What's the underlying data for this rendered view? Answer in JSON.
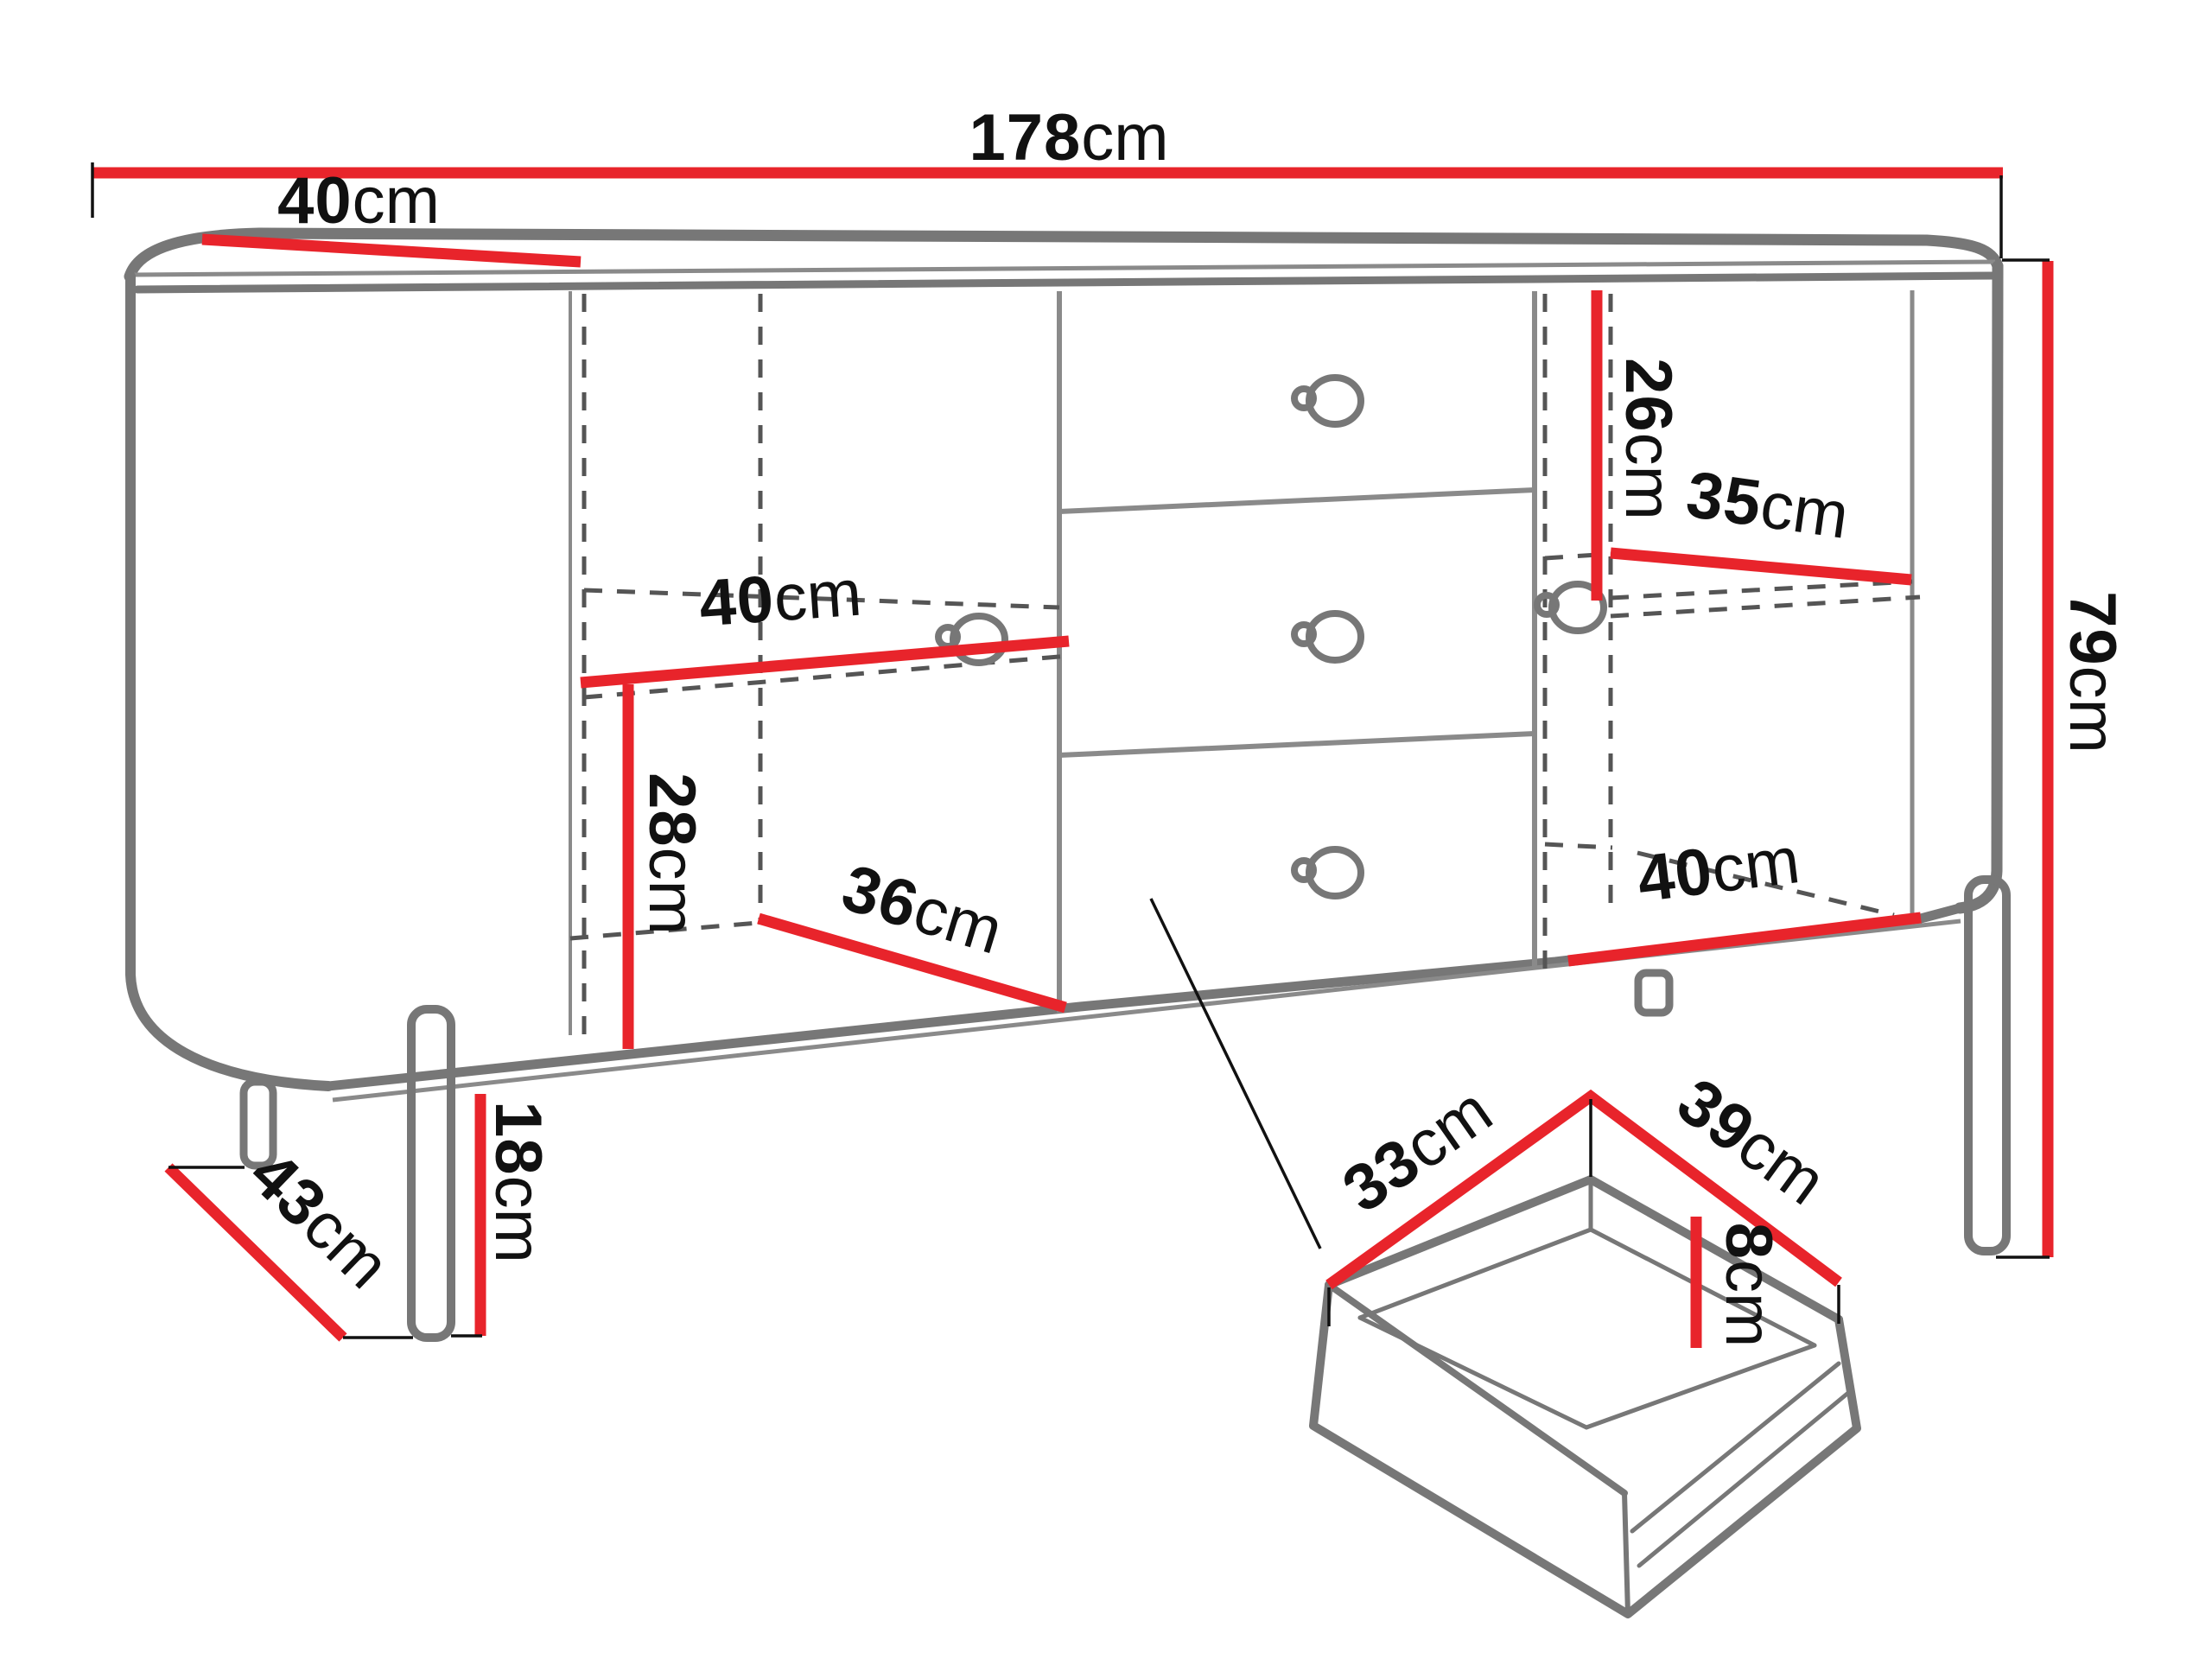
{
  "diagram": {
    "type": "furniture-dimension-drawing",
    "subject": "sideboard cabinet with two doors, three drawers and metal legs, plus detail view of a drawer box",
    "unit": "cm",
    "colors": {
      "dimension_line": "#e8242b",
      "outline": "#777777",
      "hidden_line": "#555555",
      "label_text": "#111111",
      "background": "#ffffff"
    },
    "dimensions": {
      "total_width": {
        "value": "178",
        "unit": "cm"
      },
      "top_depth": {
        "value": "40",
        "unit": "cm"
      },
      "right_upper_height": {
        "value": "26",
        "unit": "cm"
      },
      "right_shelf_width": {
        "value": "35",
        "unit": "cm"
      },
      "total_height": {
        "value": "79",
        "unit": "cm"
      },
      "left_shelf_width": {
        "value": "40",
        "unit": "cm"
      },
      "left_lower_height": {
        "value": "28",
        "unit": "cm"
      },
      "left_lower_depth": {
        "value": "36",
        "unit": "cm"
      },
      "right_lower_width": {
        "value": "40",
        "unit": "cm"
      },
      "leg_height": {
        "value": "18",
        "unit": "cm"
      },
      "leg_depth_spacing": {
        "value": "43",
        "unit": "cm"
      },
      "drawer_width": {
        "value": "33",
        "unit": "cm"
      },
      "drawer_depth": {
        "value": "39",
        "unit": "cm"
      },
      "drawer_side_height": {
        "value": "8",
        "unit": "cm"
      }
    }
  }
}
